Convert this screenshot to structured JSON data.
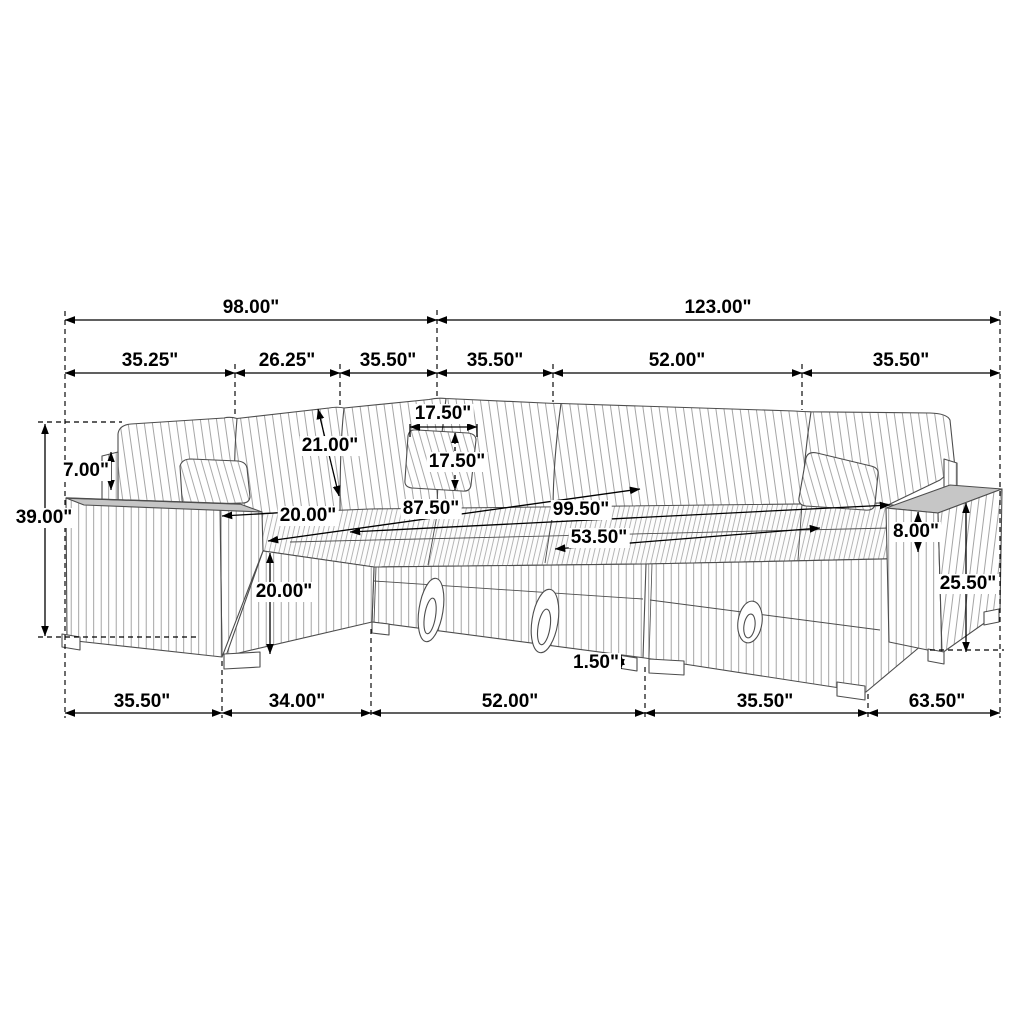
{
  "figure": {
    "kind": "furniture-dimension-diagram",
    "subject": "Modular sectional sleeper sofa with chaise and storage, corduroy upholstery",
    "unit": "inches"
  },
  "colors": {
    "background": "#ffffff",
    "furniture_line": "#4d4d4d",
    "stripe": "#9b9b9b",
    "dimension_line": "#000000",
    "label_text": "#000000",
    "label_bg": "#ffffff",
    "arm_top_shade": "#c6c6c6"
  },
  "dimensions": {
    "overall_top": [
      "98.00\"",
      "123.00\""
    ],
    "top_sections": [
      "35.25\"",
      "26.25\"",
      "35.50\"",
      "35.50\"",
      "52.00\"",
      "35.50\""
    ],
    "bottom_sections": [
      "35.50\"",
      "34.00\"",
      "52.00\"",
      "35.50\"",
      "63.50\""
    ],
    "overall_height": "39.00\"",
    "back_panel_height": "7.00\"",
    "back_cushion_length": "21.00\"",
    "pillow_width": "17.50\"",
    "pillow_height": "17.50\"",
    "seat_depth": "20.00\"",
    "sleeper_diagonals": [
      "87.50\"",
      "99.50\"",
      "53.50\""
    ],
    "seat_front_height": "20.00\"",
    "arm_above_seat_height": "8.00\"",
    "arm_height": "25.50\"",
    "leg_height": "1.50\""
  },
  "labels": [
    {
      "id": "overall-back-left",
      "text": "98.00\"",
      "x": 251,
      "y": 308
    },
    {
      "id": "overall-back-right",
      "text": "123.00\"",
      "x": 718,
      "y": 308
    },
    {
      "id": "top-section-1",
      "text": "35.25\"",
      "x": 150,
      "y": 361
    },
    {
      "id": "top-section-2",
      "text": "26.25\"",
      "x": 287,
      "y": 361
    },
    {
      "id": "top-section-3",
      "text": "35.50\"",
      "x": 388,
      "y": 361
    },
    {
      "id": "top-section-4",
      "text": "35.50\"",
      "x": 495,
      "y": 361
    },
    {
      "id": "top-section-5",
      "text": "52.00\"",
      "x": 677,
      "y": 361
    },
    {
      "id": "top-section-6",
      "text": "35.50\"",
      "x": 901,
      "y": 361
    },
    {
      "id": "back-panel-height",
      "text": "7.00\"",
      "x": 86,
      "y": 471
    },
    {
      "id": "overall-height",
      "text": "39.00\"",
      "x": 44,
      "y": 518
    },
    {
      "id": "back-cushion-length",
      "text": "21.00\"",
      "x": 330,
      "y": 446
    },
    {
      "id": "pillow-width",
      "text": "17.50\"",
      "x": 443,
      "y": 414
    },
    {
      "id": "pillow-height",
      "text": "17.50\"",
      "x": 457,
      "y": 462
    },
    {
      "id": "seat-depth",
      "text": "20.00\"",
      "x": 308,
      "y": 516
    },
    {
      "id": "sleeper-length-87",
      "text": "87.50\"",
      "x": 431,
      "y": 509
    },
    {
      "id": "sleeper-length-99",
      "text": "99.50\"",
      "x": 581,
      "y": 510
    },
    {
      "id": "sleeper-length-53",
      "text": "53.50\"",
      "x": 599,
      "y": 538
    },
    {
      "id": "seat-front-height",
      "text": "20.00\"",
      "x": 284,
      "y": 592
    },
    {
      "id": "arm-above-seat-height",
      "text": "8.00\"",
      "x": 916,
      "y": 532
    },
    {
      "id": "arm-height",
      "text": "25.50\"",
      "x": 968,
      "y": 584
    },
    {
      "id": "leg-height",
      "text": "1.50\"",
      "x": 596,
      "y": 663
    },
    {
      "id": "bottom-section-1",
      "text": "35.50\"",
      "x": 142,
      "y": 702
    },
    {
      "id": "bottom-section-2",
      "text": "34.00\"",
      "x": 297,
      "y": 702
    },
    {
      "id": "bottom-section-3",
      "text": "52.00\"",
      "x": 510,
      "y": 702
    },
    {
      "id": "bottom-section-4",
      "text": "35.50\"",
      "x": 765,
      "y": 702
    },
    {
      "id": "bottom-section-5",
      "text": "63.50\"",
      "x": 937,
      "y": 702
    }
  ]
}
